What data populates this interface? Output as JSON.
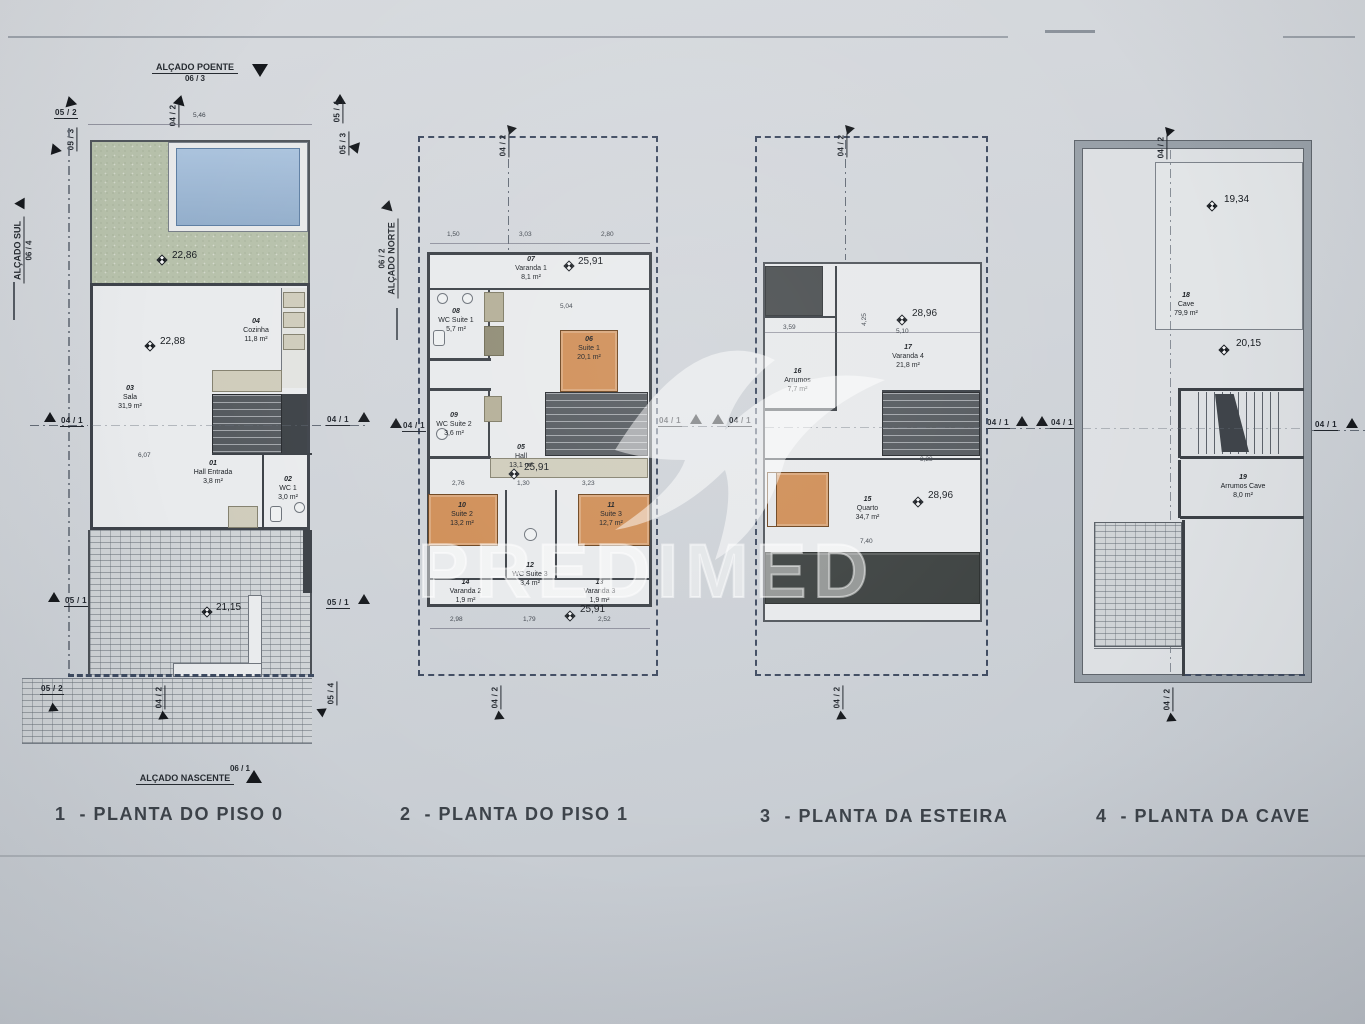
{
  "sheet": {
    "watermark": "PREDIMED",
    "captions": [
      "1  - PLANTA DO PISO 0",
      "2  - PLANTA DO PISO 1",
      "3  - PLANTA DA ESTEIRA",
      "4  - PLANTA DA CAVE"
    ]
  },
  "elevations": {
    "poente": {
      "name": "ALÇADO POENTE",
      "ref": "06 / 3"
    },
    "nascente": {
      "name": "ALÇADO NASCENTE",
      "ref": "06 / 1"
    },
    "sul": {
      "name": "ALÇADO SUL",
      "ref": "06 / 4"
    },
    "norte": {
      "name": "ALÇADO NORTE",
      "ref": "06 / 2"
    }
  },
  "refs": {
    "s052": "05 / 2",
    "s053": "05 / 3",
    "s054": "05 / 4",
    "s051": "05 / 1",
    "s042": "04 / 2",
    "s041": "04 / 1"
  },
  "plans": [
    {
      "levels": {
        "garden": "22,86",
        "sala": "22,88",
        "terrace": "21,15"
      },
      "rooms": [
        {
          "num": "01",
          "name": "Hall Entrada",
          "area": "3,8 m²"
        },
        {
          "num": "02",
          "name": "WC 1",
          "area": "3,0 m²"
        },
        {
          "num": "03",
          "name": "Sala",
          "area": "31,9 m²"
        },
        {
          "num": "04",
          "name": "Cozinha",
          "area": "11,8 m²"
        }
      ],
      "dims": {
        "top": "5,46",
        "left": "6,07"
      }
    },
    {
      "levels": {
        "varanda": "25,91",
        "hall": "25,91",
        "bottom": "25,91"
      },
      "rooms": [
        {
          "num": "05",
          "name": "Hall",
          "area": "13,1 m²"
        },
        {
          "num": "06",
          "name": "Suite 1",
          "area": "20,1 m²"
        },
        {
          "num": "07",
          "name": "Varanda 1",
          "area": "8,1 m²"
        },
        {
          "num": "08",
          "name": "WC Suite 1",
          "area": "5,7 m²"
        },
        {
          "num": "09",
          "name": "WC Suite 2",
          "area": "3,6 m²"
        },
        {
          "num": "10",
          "name": "Suite 2",
          "area": "13,2 m²"
        },
        {
          "num": "11",
          "name": "Suite 3",
          "area": "12,7 m²"
        },
        {
          "num": "12",
          "name": "WC Suite 3",
          "area": "3,4 m²"
        },
        {
          "num": "13",
          "name": "Varanda 3",
          "area": "1,9 m²"
        },
        {
          "num": "14",
          "name": "Varanda 2",
          "area": "1,9 m²"
        }
      ],
      "dims": {
        "top": [
          "1,50",
          "3,03",
          "2,80"
        ],
        "upper": "5,04",
        "mid": [
          "2,76",
          "1,30",
          "3,23"
        ],
        "bottom": [
          "2,98",
          "1,79",
          "2,52"
        ]
      }
    },
    {
      "levels": {
        "varanda": "28,96",
        "quarto": "28,96"
      },
      "rooms": [
        {
          "num": "15",
          "name": "Quarto",
          "area": "34,7 m²"
        },
        {
          "num": "16",
          "name": "Arrumos",
          "area": "7,7 m²"
        },
        {
          "num": "17",
          "name": "Varanda 4",
          "area": "21,8 m²"
        }
      ],
      "dims": {
        "d1": "3,59",
        "d2": "5,10",
        "d3": "4,25",
        "d4": "3,28",
        "d5": "7,40"
      }
    },
    {
      "levels": {
        "upper": "19,34",
        "lower": "20,15"
      },
      "rooms": [
        {
          "num": "18",
          "name": "Cave",
          "area": "79,9 m²"
        },
        {
          "num": "19",
          "name": "Arrumos Cave",
          "area": "8,0 m²"
        }
      ]
    }
  ]
}
